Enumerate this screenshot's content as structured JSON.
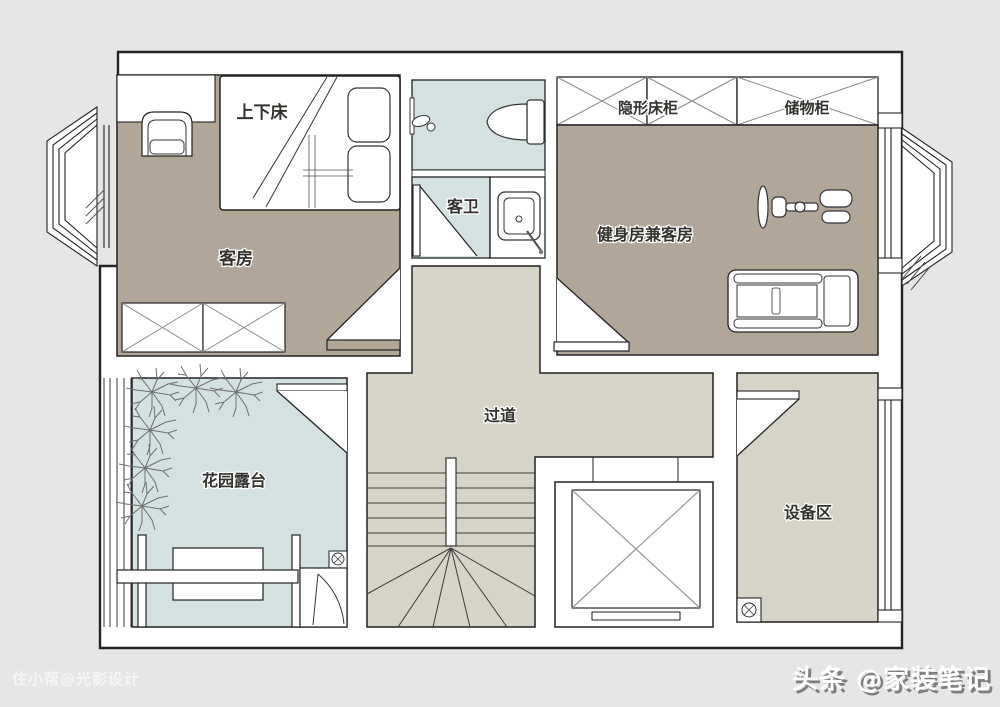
{
  "plan": {
    "labels": {
      "bunk_bed": "上下床",
      "guest_room": "客房",
      "guest_bathroom": "客卫",
      "hidden_bed_cabinet": "隐形床柜",
      "storage_cabinet": "储物柜",
      "gym_guest_room": "健身房兼客房",
      "corridor": "过道",
      "garden_terrace": "花园露台",
      "equipment_area": "设备区"
    }
  },
  "watermarks": {
    "designer_credit": "住小帮@光影设计",
    "publisher": "头条 @家装笔记"
  },
  "colors": {
    "background": "#e7e6e4",
    "floor_taupe": "#b1a698",
    "floor_blue": "#d3e2e1",
    "floor_gray": "#d6d4c7",
    "wall_line": "#222222"
  }
}
